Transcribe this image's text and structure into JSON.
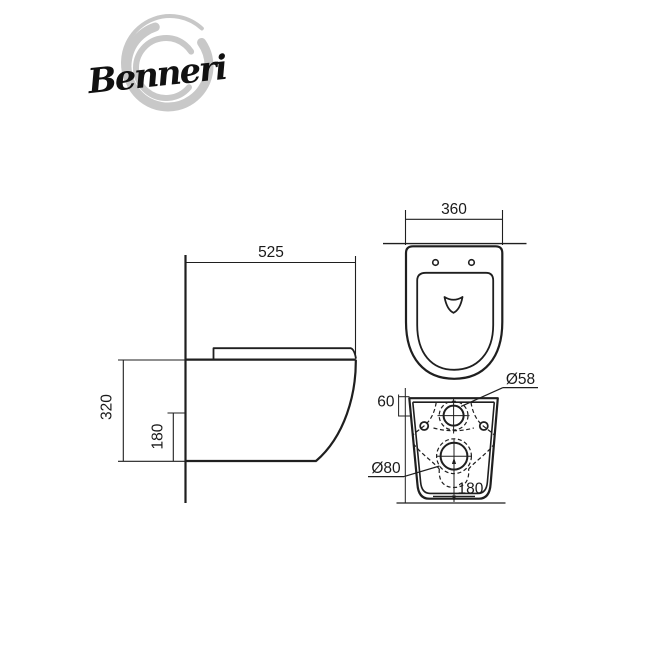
{
  "brand": {
    "name": "Benneri"
  },
  "colors": {
    "line": "#1f1f1f",
    "dim_line": "#3a3a3a",
    "logo_swirl": "#c8c8c8",
    "background": "#ffffff"
  },
  "views": {
    "side": {
      "width_mm": "525",
      "height_mm": "320",
      "lower_edge_mm": "180"
    },
    "top": {
      "width_mm": "360"
    },
    "rear": {
      "inlet_top_offset_mm": "60",
      "inlet_diameter": "Ø58",
      "outlet_diameter": "Ø80",
      "outlet_center_height_mm": "180"
    }
  }
}
